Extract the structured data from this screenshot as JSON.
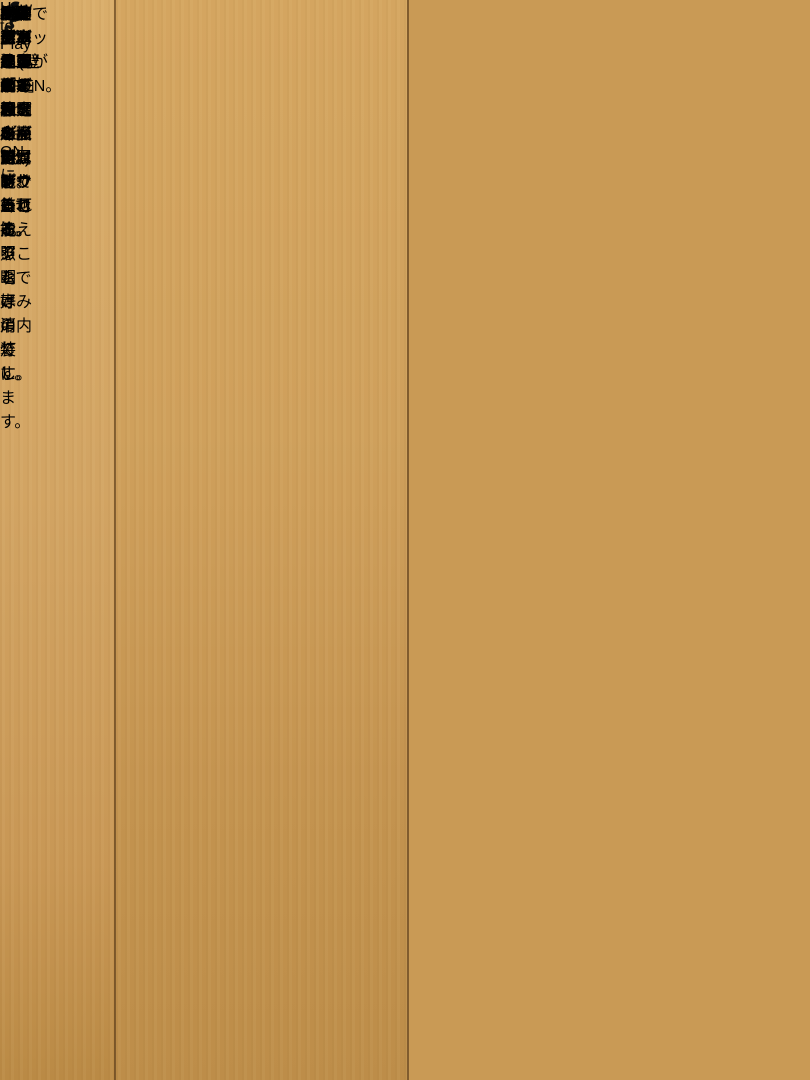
{
  "box": {
    "title": "How to Play",
    "steps": [
      {
        "caption": [
          "天面のメインスイッチをONに。"
        ]
      },
      {
        "caption": [
          "操作パネルの「∧」をタッチ。",
          "※操作パネルは、静電タッチセンサーです。"
        ]
      },
      {
        "caption": [
          "電動でシャッターがOPEN。"
        ]
      },
      {
        "caption": [
          "開き終わると同時に、",
          "ゆっくりと室内の照明が点灯。",
          "※シャッターを閉じると照明は消灯します。"
        ]
      }
    ],
    "sets": {
      "a_label": "Aセット×1(壁面3枚、床面1枚)",
      "b_label": "Bセット×1(壁面3枚、床面1枚)",
      "caption": "内装デザイン紙が2セット付属し、差し換えることで好みの内装に。"
    },
    "layout_note": [
      "4台のトミカを好きなレイアウトで飾れる。",
      "※乗用車タイプで最大4台レイアウト可能。",
      "※本製品はトミカプレミアム専用です。"
    ],
    "display_note": [
      "別売りのトミカガレージを",
      "横に並べて展示することが可能。",
      "※結合力はありません。",
      "※動きが連動するなどの機能はありません。"
    ]
  },
  "colors": {
    "wood": "#cf9f5b",
    "box_face": "#e7e6e2",
    "panel_black": "#1c1c1c",
    "wall_beige": "#cabd9b",
    "rule_line": "#3d3d3d"
  }
}
